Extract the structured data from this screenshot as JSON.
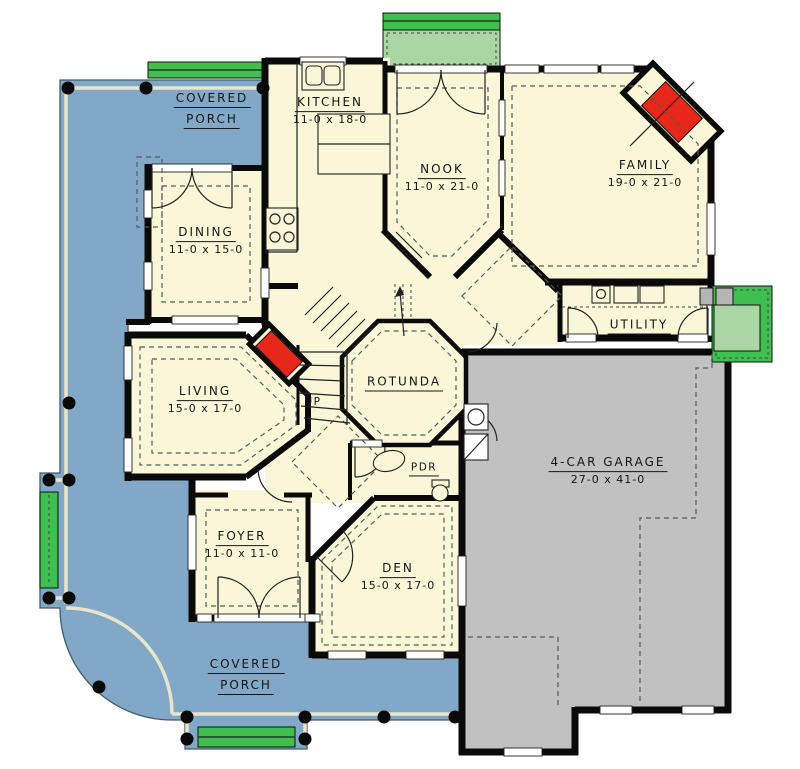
{
  "title": "First floor plan",
  "rooms": {
    "porch_top": {
      "line1": "COVERED",
      "line2": "PORCH"
    },
    "kitchen": {
      "name": "KITCHEN",
      "dims": "11-0 x 18-0"
    },
    "nook": {
      "name": "NOOK",
      "dims": "11-0 x 21-0"
    },
    "family": {
      "name": "FAMILY",
      "dims": "19-0 x 21-0"
    },
    "dining": {
      "name": "DINING",
      "dims": "11-0 x 15-0"
    },
    "living": {
      "name": "LIVING",
      "dims": "15-0 x 17-0"
    },
    "rotunda": {
      "name": "ROTUNDA"
    },
    "stairs": {
      "up": "UP"
    },
    "utility": {
      "name": "UTILITY"
    },
    "pdr": {
      "name": "PDR"
    },
    "garage": {
      "name": "4-CAR GARAGE",
      "dims": "27-0 x 41-0"
    },
    "den": {
      "name": "DEN",
      "dims": "15-0 x 17-0"
    },
    "foyer": {
      "name": "FOYER",
      "dims": "11-0 x 11-0"
    },
    "porch_bottom": {
      "line1": "COVERED",
      "line2": "PORCH"
    }
  },
  "colors": {
    "porch": "#81A9C7",
    "house": "#FAF6D8",
    "garage": "#C1C1C1",
    "steps_green": "#3FBF4F",
    "stoop_light_green": "#A9D6A2",
    "fireplace_red": "#E8271B",
    "wall_black": "#0A0A0A"
  }
}
